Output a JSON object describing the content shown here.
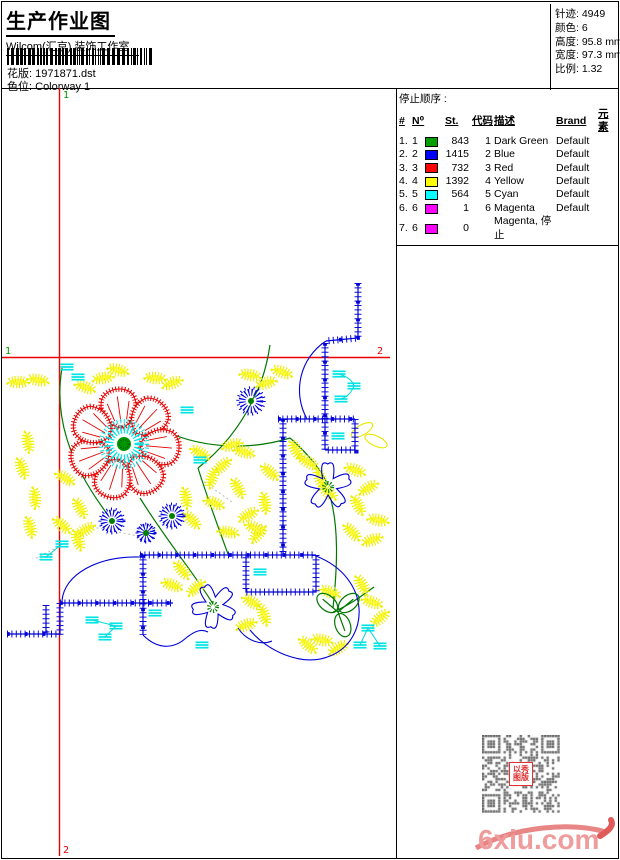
{
  "header": {
    "title": "生产作业图",
    "company": "Wilcom(汇京) 装饰工作室",
    "design_label": "花版:",
    "design_value": "1971871.dst",
    "colorway_label": "色位:",
    "colorway_value": "Colorway 1"
  },
  "stats": [
    {
      "label": "针迹:",
      "value": "4949"
    },
    {
      "label": "颜色:",
      "value": "6"
    },
    {
      "label": "高度:",
      "value": "95.8 mm"
    },
    {
      "label": "宽度:",
      "value": "97.3 mm"
    },
    {
      "label": "比例:",
      "value": "1.32"
    }
  ],
  "stop_sequence": {
    "title": "停止顺序 :",
    "columns": [
      "#",
      "N⁰",
      "",
      "St.",
      "代码",
      "描述",
      "Brand",
      "元素"
    ],
    "rows": [
      {
        "seq": "1.",
        "needle": "1",
        "swatch": "#00a000",
        "st": "843",
        "code": "1",
        "desc": "Dark Green",
        "brand": "Default",
        "elem": ""
      },
      {
        "seq": "2.",
        "needle": "2",
        "swatch": "#0000ff",
        "st": "1415",
        "code": "2",
        "desc": "Blue",
        "brand": "Default",
        "elem": ""
      },
      {
        "seq": "3.",
        "needle": "3",
        "swatch": "#ff0000",
        "st": "732",
        "code": "3",
        "desc": "Red",
        "brand": "Default",
        "elem": ""
      },
      {
        "seq": "4.",
        "needle": "4",
        "swatch": "#ffff00",
        "st": "1392",
        "code": "4",
        "desc": "Yellow",
        "brand": "Default",
        "elem": ""
      },
      {
        "seq": "5.",
        "needle": "5",
        "swatch": "#00ffff",
        "st": "564",
        "code": "5",
        "desc": "Cyan",
        "brand": "Default",
        "elem": ""
      },
      {
        "seq": "6.",
        "needle": "6",
        "swatch": "#ff00ff",
        "st": "1",
        "code": "6",
        "desc": "Magenta",
        "brand": "Default",
        "elem": ""
      },
      {
        "seq": "7.",
        "needle": "6",
        "swatch": "#ff00ff",
        "st": "0",
        "code": "",
        "desc": "Magenta, 停止",
        "brand": "",
        "elem": ""
      }
    ]
  },
  "marks": {
    "one": "1",
    "two": "2"
  },
  "colors": {
    "registration_line": "#ee0000",
    "mark_start": "#00a000",
    "mark_end": "#ee0000"
  },
  "watermark": {
    "logo": "6xiu.com",
    "stamp_line1": "以秀",
    "stamp_line2": "图版"
  }
}
